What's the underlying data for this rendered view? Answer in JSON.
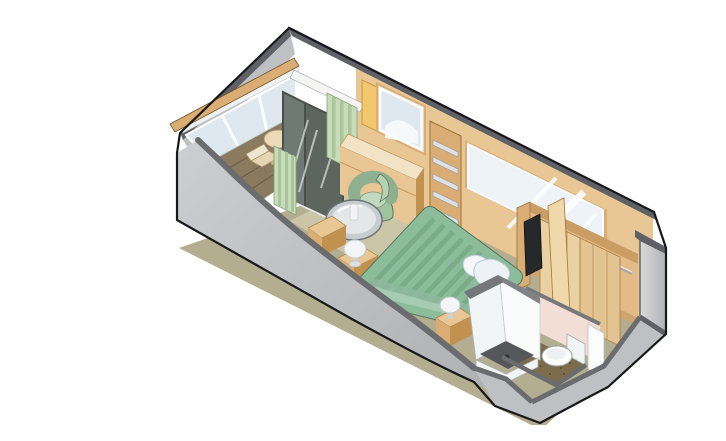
{
  "meta": {
    "description": "Isometric cutaway illustration of a cruise ship balcony stateroom floor plan with balcony, sitting area, bed, wardrobe and bathroom",
    "background": "#ffffff"
  },
  "palette": {
    "outline": "#17181a",
    "wall_cap": "#5f6166",
    "wall_cap_soft": "#6b6c70",
    "wall_gray": "#bfc0c4",
    "wall_gray_light": "#d3d4d7",
    "wood": "#e9c795",
    "wood_mid": "#d9ad74",
    "wood_dark": "#c1924f",
    "wood_pale": "#f1e3c4",
    "closet_wood": "#e2bb87",
    "closet_door": "#ead0a2",
    "closet_door2": "#e3c38f",
    "floor": "#b3ae90",
    "floor_light": "#d9d2b5",
    "deck": "#8a7a5e",
    "deck_line": "#6b5d45",
    "bed_green": "#8cbd9b",
    "bed_stripe": "#79aa88",
    "bed_blanket": "#a8cdb2",
    "bed_rim": "#55755f",
    "chair_green": "#9fc2a0",
    "chair_green_deep": "#85ab88",
    "curtain": "#c8dcba",
    "curtain_stripe": "#a9c59c",
    "glass": "#dfe8ef",
    "mirror": "#eef3f7",
    "door_glass": "#707a75",
    "door_frame": "#4a4f4c",
    "bath_pink": "#f3ded5",
    "bath_pink_dark": "#eccfc5",
    "bath_floor": "#7d6c4c",
    "shower_floor": "#55575a",
    "white_fixture": "#f7f9fa",
    "metal": "#c9cccd",
    "tv": "#26292c",
    "accent_yellow": "#f3c76d",
    "lamp_white": "#f3f5f6",
    "balcony_furniture": "#f0e6cf"
  },
  "objects": {
    "scene": {
      "label": "Stateroom floor plan"
    },
    "balcony": {
      "label": "Private balcony with railing, two chairs and table"
    },
    "railing": {
      "label": "Balcony railing"
    },
    "deck": {
      "label": "Balcony deck"
    },
    "slidingdoor": {
      "label": "Sliding glass door"
    },
    "curtains": {
      "label": "Curtains"
    },
    "sitting": {
      "label": "Sitting area with armchair and glass table"
    },
    "vanity": {
      "label": "Vanity desk with mirror"
    },
    "shelves": {
      "label": "Shelf unit"
    },
    "wallmirror": {
      "label": "Wall mirror"
    },
    "bed": {
      "label": "Queen bed with striped cover"
    },
    "wardrobe": {
      "label": "Wardrobe with hanging rod"
    },
    "tv": {
      "label": "Television"
    },
    "bathroom": {
      "label": "Bathroom with shower and toilet"
    },
    "shower": {
      "label": "Shower"
    },
    "toilet": {
      "label": "Toilet"
    }
  }
}
